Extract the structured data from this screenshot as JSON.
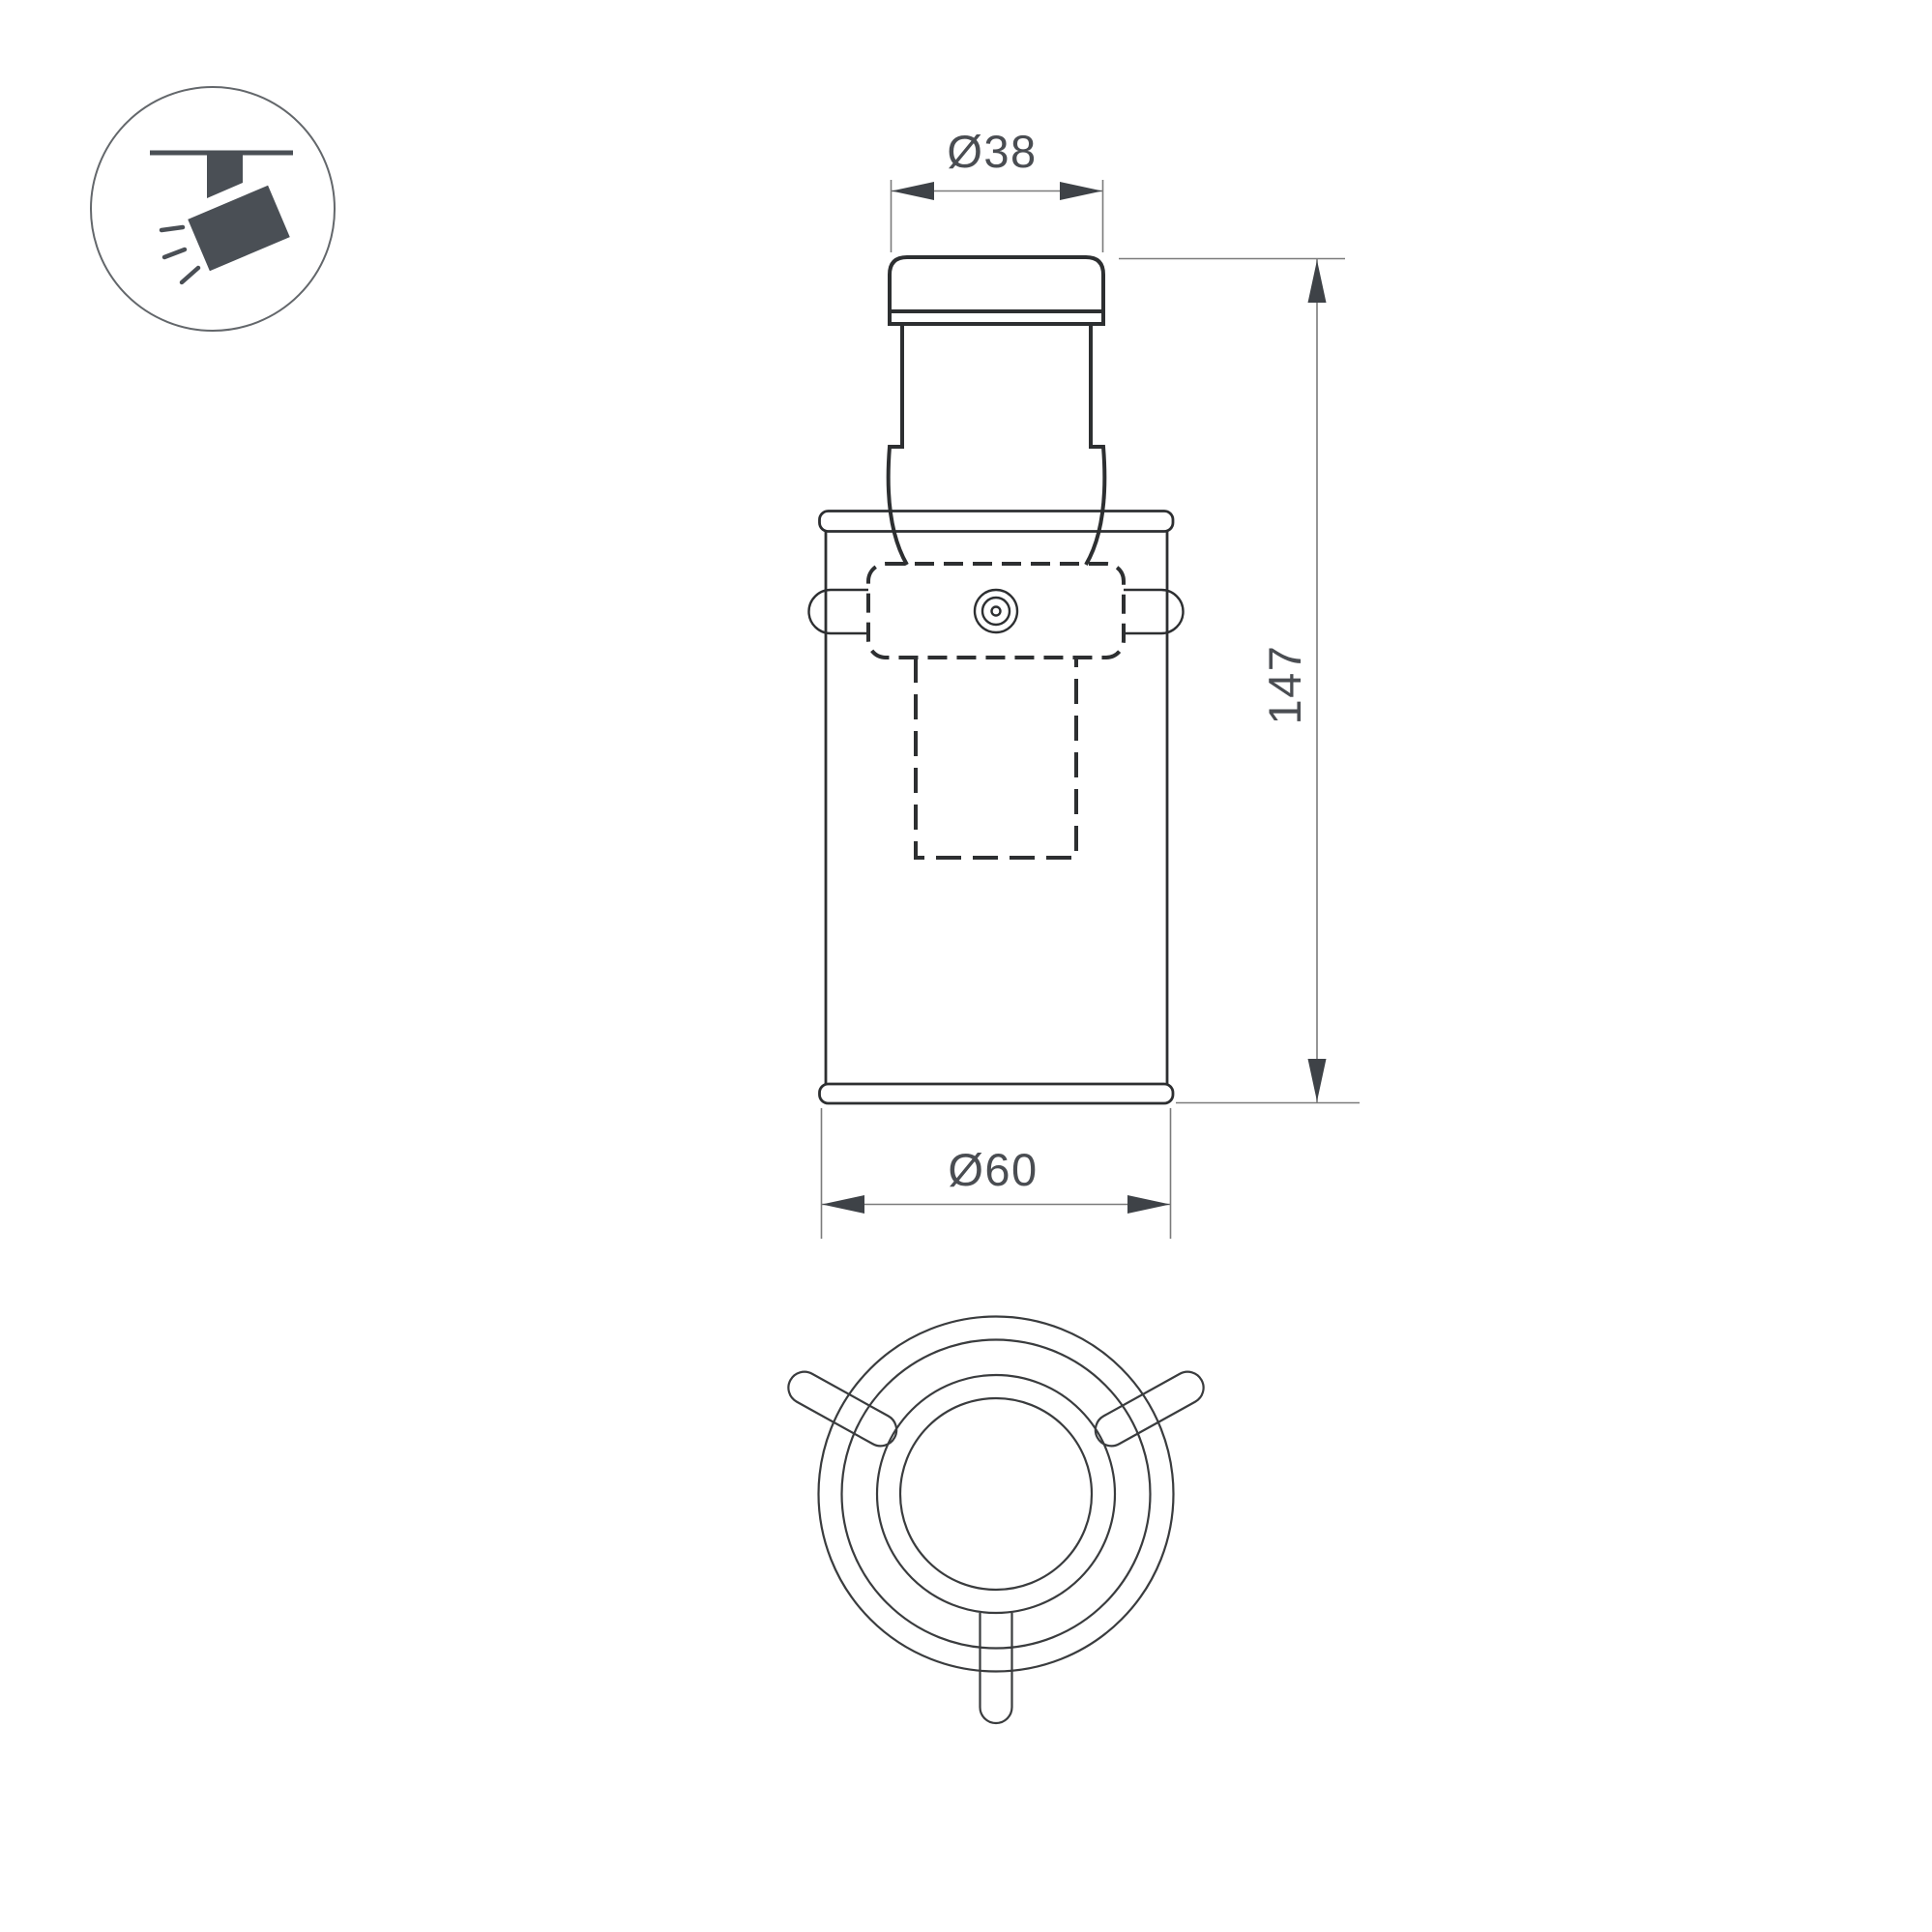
{
  "page": {
    "background": "#ffffff"
  },
  "legend_icon": {
    "name": "track-spotlight-icon"
  },
  "drawing": {
    "type": "luminaire-technical-drawing",
    "views": {
      "front": "front elevation",
      "bottom": "bottom view"
    },
    "dimensions": {
      "top_diameter": "Ø38",
      "height": "147",
      "bottom_diameter": "Ø60"
    }
  },
  "colors": {
    "object_line": "#2d2f31",
    "secondary_line": "#3a3c3e",
    "dimension_line": "#7b7b7b",
    "arrowhead": "#3e4247",
    "dimension_text": "#4a4d52",
    "icon_fill": "#4a4f55",
    "icon_circle_stroke": "#63676b"
  }
}
